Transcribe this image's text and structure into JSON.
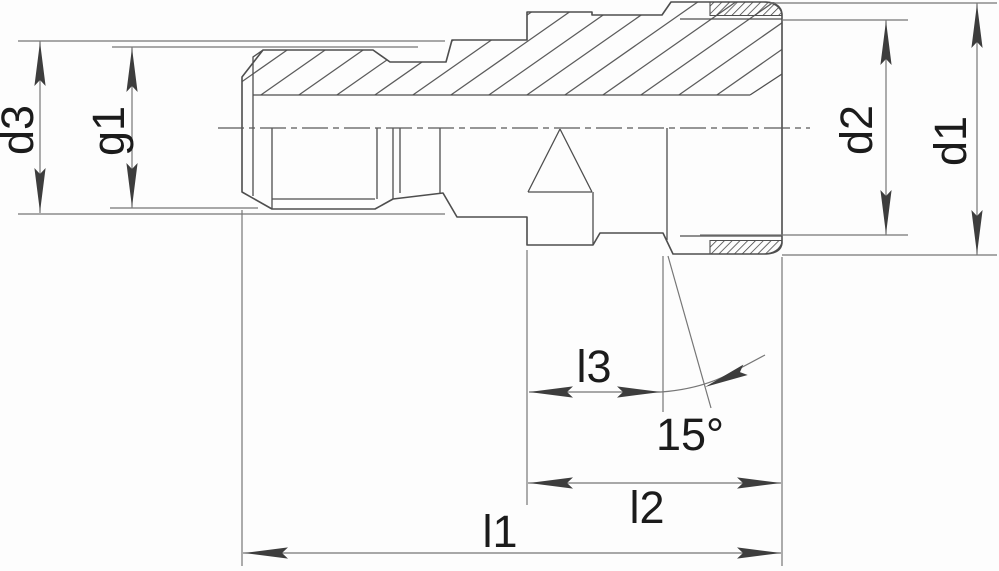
{
  "labels": {
    "d1": "d1",
    "d2": "d2",
    "d3": "d3",
    "g1": "g1",
    "l1": "l1",
    "l2": "l2",
    "l3": "l3",
    "angle": "15°"
  },
  "colors": {
    "background": "#fdfdfd",
    "outline": "#4e4e4e",
    "thin_line": "#767676",
    "arrow": "#3d3d3d",
    "text": "#1b1b1b",
    "hatch": "#5c5c5c"
  }
}
